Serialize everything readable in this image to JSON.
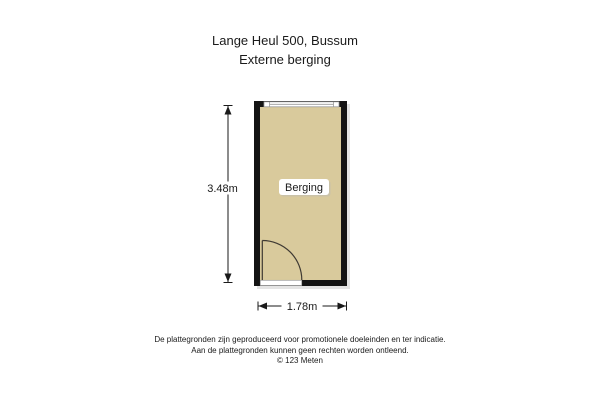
{
  "header": {
    "title": "Lange Heul 500, Bussum",
    "subtitle": "Externe berging"
  },
  "floorplan": {
    "room_label": "Berging",
    "dim_height": "3.48m",
    "dim_width": "1.78m",
    "colors": {
      "floor": "#d9ca9c",
      "wall": "#141414",
      "window_frame": "#9a9a9a",
      "door": "#3f3a33",
      "dimension": "#1a1a1a"
    }
  },
  "footer": {
    "line1": "De plattegronden zijn geproduceerd voor promotionele doeleinden en ter indicatie.",
    "line2": "Aan de plattegronden kunnen geen rechten worden ontleend.",
    "line3": "© 123 Meten"
  }
}
